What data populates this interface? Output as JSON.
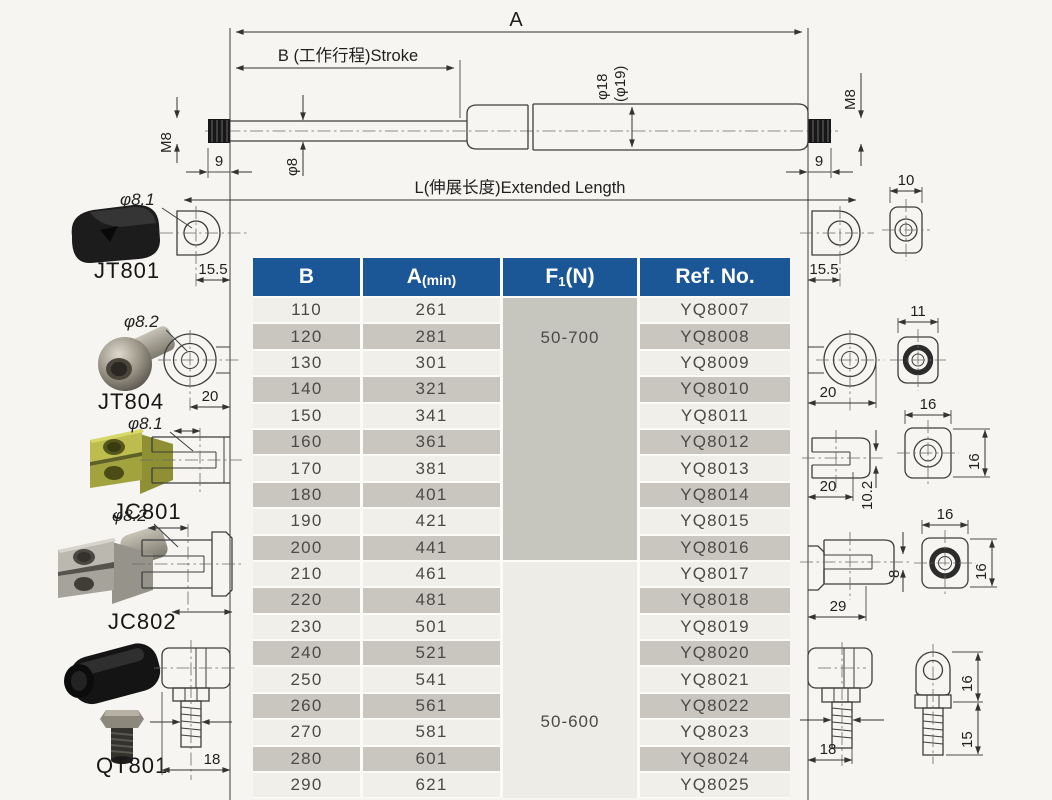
{
  "drawing": {
    "dim_a": "A",
    "dim_b_stroke": "B (工作行程)Stroke",
    "dim_extended": "L(伸展长度)Extended Length",
    "dim_rod_dia": "φ8",
    "dim_tube_dia": "φ18",
    "dim_tube_dia2": "(φ19)",
    "dim_thread": "M8",
    "dim_thread_len": "9",
    "dim_eyelet_offset": "15.5",
    "dim_eyelet_front_w": "10",
    "dim_ball_front_w": "11",
    "dim_ball_offset": "20",
    "dim_clevis1_offset": "20",
    "dim_clevis1_slot": "10.2",
    "dim_clevis1_front_w": "16",
    "dim_clevis1_front_h": "16",
    "dim_clevis2_len": "29",
    "dim_clevis2_slot": "8",
    "dim_clevis2_front_w": "16",
    "dim_clevis2_front_h": "16",
    "dim_balljoint_stud": "18",
    "dim_balljoint_h1": "16",
    "dim_balljoint_h2": "15"
  },
  "left_fittings": [
    {
      "name": "JT801",
      "callout": "φ8.1",
      "dim": "15.5"
    },
    {
      "name": "JT804",
      "callout": "φ8.2",
      "dim": "20"
    },
    {
      "name": "JC801",
      "callout": "φ8.1"
    },
    {
      "name": "JC802",
      "callout": "φ8.2"
    },
    {
      "name": "QT801",
      "dim": "18"
    }
  ],
  "table": {
    "headers": {
      "b": "B",
      "a_main": "A",
      "a_sub": "(min)",
      "f_main": "F",
      "f_sub": "1",
      "f_suffix": "(N)",
      "ref": "Ref. No."
    },
    "force_groups": [
      {
        "label": "50-700",
        "row_span": 10
      },
      {
        "label": "50-600",
        "row_span": 9
      }
    ],
    "rows": [
      {
        "b": "110",
        "a": "261",
        "ref": "YQ8007"
      },
      {
        "b": "120",
        "a": "281",
        "ref": "YQ8008"
      },
      {
        "b": "130",
        "a": "301",
        "ref": "YQ8009"
      },
      {
        "b": "140",
        "a": "321",
        "ref": "YQ8010"
      },
      {
        "b": "150",
        "a": "341",
        "ref": "YQ8011"
      },
      {
        "b": "160",
        "a": "361",
        "ref": "YQ8012"
      },
      {
        "b": "170",
        "a": "381",
        "ref": "YQ8013"
      },
      {
        "b": "180",
        "a": "401",
        "ref": "YQ8014"
      },
      {
        "b": "190",
        "a": "421",
        "ref": "YQ8015"
      },
      {
        "b": "200",
        "a": "441",
        "ref": "YQ8016"
      },
      {
        "b": "210",
        "a": "461",
        "ref": "YQ8017"
      },
      {
        "b": "220",
        "a": "481",
        "ref": "YQ8018"
      },
      {
        "b": "230",
        "a": "501",
        "ref": "YQ8019"
      },
      {
        "b": "240",
        "a": "521",
        "ref": "YQ8020"
      },
      {
        "b": "250",
        "a": "541",
        "ref": "YQ8021"
      },
      {
        "b": "260",
        "a": "561",
        "ref": "YQ8022"
      },
      {
        "b": "270",
        "a": "581",
        "ref": "YQ8023"
      },
      {
        "b": "280",
        "a": "601",
        "ref": "YQ8024"
      },
      {
        "b": "290",
        "a": "621",
        "ref": "YQ8025"
      }
    ]
  },
  "colors": {
    "header_blue": "#1b5796",
    "row_light": "#f0efe9",
    "row_dark": "#c8c6bf",
    "force_block_gray": "#c6c5be",
    "force_block_light": "#edece7"
  }
}
